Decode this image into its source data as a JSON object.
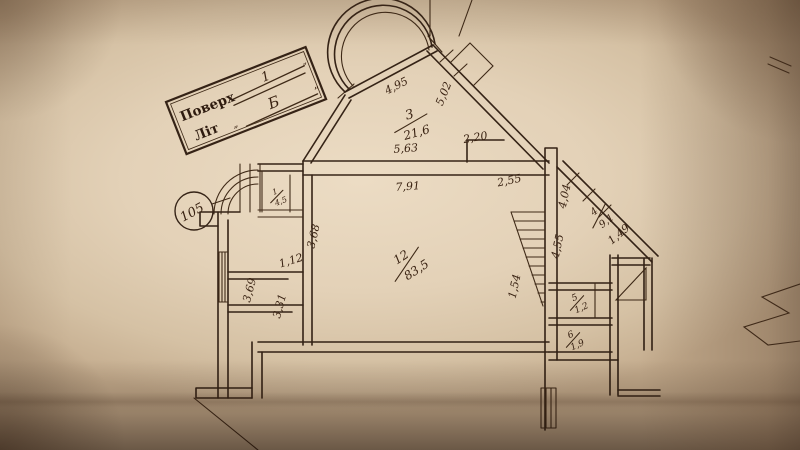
{
  "photo": {
    "description": "Photograph of an architectural floor plan drawing on beige paper",
    "paper_color": "#decbb0",
    "ink_color": "#3b2a1e"
  },
  "title_block": {
    "floor_label": "Поверх",
    "floor_value": "1",
    "floor_quote": "”",
    "lit_label": "Літ",
    "lit_open_quote": "„",
    "lit_value": "Б",
    "lit_close_quote": "”"
  },
  "reference_circle": {
    "label": "105"
  },
  "rooms": [
    {
      "number": "3",
      "area": "21,6"
    },
    {
      "number": "12",
      "area": "83,5"
    },
    {
      "number": "4",
      "area": "9,1"
    },
    {
      "number": "1",
      "area": "4,5"
    },
    {
      "number": "5",
      "area": "1,2"
    },
    {
      "number": "6",
      "area": "1,9"
    }
  ],
  "dimensions": {
    "bay_window_chord": "4,95",
    "upper_diagonal_wall": "5,02",
    "room3_base_left": "5,63",
    "room3_base_right": "2,20",
    "room12_top": "7,91",
    "room12_corner": "2,55",
    "entry_depth": "3,68",
    "closet_width": "1,12",
    "left_room_lower": "3,69",
    "left_room_mid": "3,31",
    "stair_width": "1,54",
    "landing_upper": "4,04",
    "landing_lower": "4,55",
    "balcony_edge": "1,49"
  }
}
